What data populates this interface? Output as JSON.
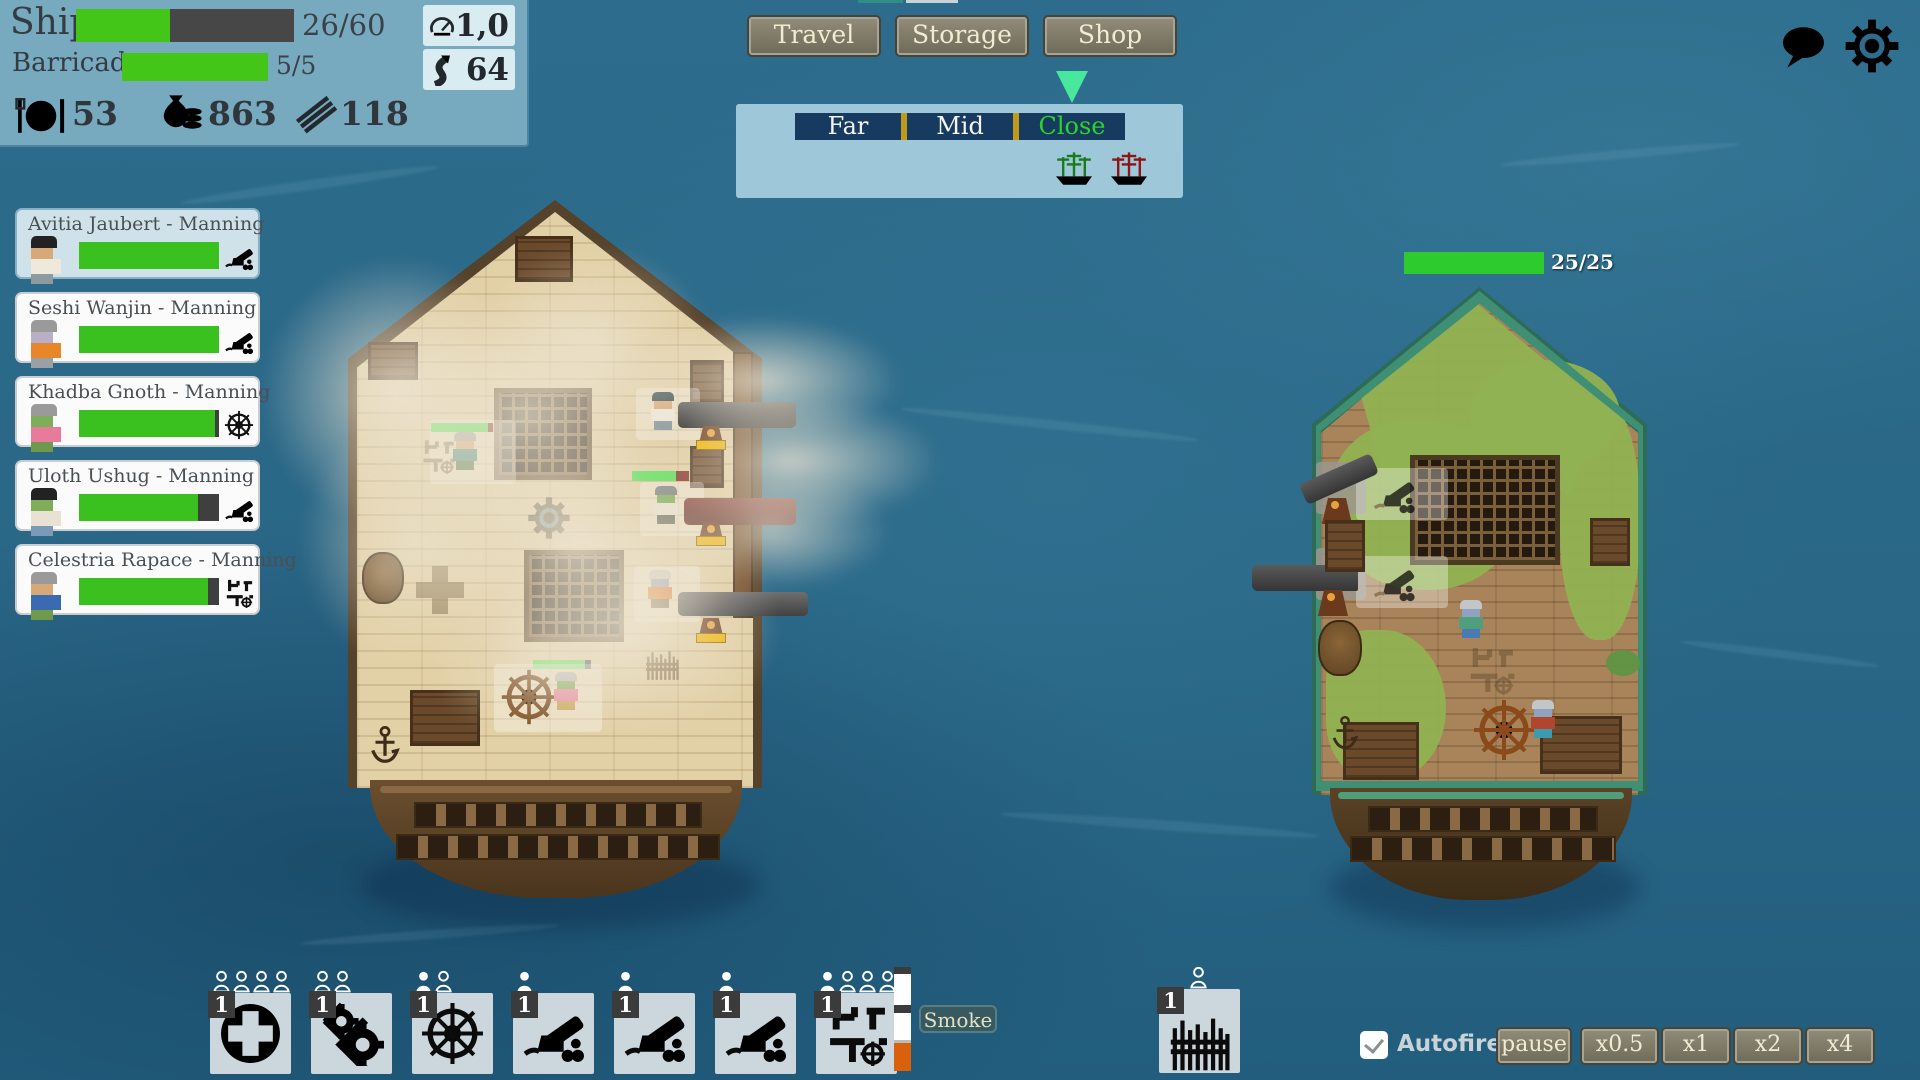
{
  "hud": {
    "ship_label": "Ship",
    "ship_value": "26/60",
    "ship_pct": 43,
    "barricade_label": "Barricade",
    "barricade_value": "5/5",
    "barricade_pct": 100,
    "food": "53",
    "gold": "863",
    "planks": "118",
    "speed": "1,0",
    "distance": "64"
  },
  "top_nav": {
    "travel": "Travel",
    "storage": "Storage",
    "shop": "Shop"
  },
  "range": {
    "far": "Far",
    "mid": "Mid",
    "close": "Close",
    "selected": "Close"
  },
  "crew": [
    {
      "name": "Avitia Jaubert - Manning",
      "hp_pct": 100,
      "station": "cannon",
      "selected": true
    },
    {
      "name": "Seshi Wanjin - Manning",
      "hp_pct": 100,
      "station": "cannon",
      "selected": false
    },
    {
      "name": "Khadba Gnoth - Manning",
      "hp_pct": 97,
      "station": "helm",
      "selected": false
    },
    {
      "name": "Uloth Ushug - Manning",
      "hp_pct": 85,
      "station": "cannon",
      "selected": false
    },
    {
      "name": "Celestria Rapace - Manning",
      "hp_pct": 92,
      "station": "deck-plan",
      "selected": false
    }
  ],
  "enemy": {
    "hp_text": "25/25",
    "hp_pct": 100
  },
  "deck_bars": {
    "station_hp": 92,
    "gun2_hp": 78,
    "helm_hp": 90,
    "reload1": 100,
    "reload2": 100,
    "reload3": 100
  },
  "actions": [
    {
      "name": "heal",
      "badge": "1",
      "slots_filled": 0,
      "slots_empty": 4
    },
    {
      "name": "repair",
      "badge": "1",
      "slots_filled": 0,
      "slots_empty": 2
    },
    {
      "name": "helm",
      "badge": "1",
      "slots_filled": 1,
      "slots_empty": 1
    },
    {
      "name": "cannon-1",
      "badge": "1",
      "slots_filled": 1,
      "slots_empty": 0
    },
    {
      "name": "cannon-2",
      "badge": "1",
      "slots_filled": 1,
      "slots_empty": 0
    },
    {
      "name": "cannon-3",
      "badge": "1",
      "slots_filled": 1,
      "slots_empty": 0
    },
    {
      "name": "deck-stations",
      "badge": "1",
      "slots_filled": 1,
      "slots_empty": 3
    },
    {
      "name": "barricade",
      "badge": "1",
      "slots_filled": 0,
      "slots_empty": 1
    }
  ],
  "gauge": {
    "segments": [
      {
        "color": "#3b3b3b",
        "pct": 7
      },
      {
        "color": "#ffffff",
        "pct": 30
      },
      {
        "color": "#3b3b3b",
        "pct": 7
      },
      {
        "color": "#ffffff",
        "pct": 26
      },
      {
        "color": "#bcbcbc",
        "pct": 3
      },
      {
        "color": "#d9610e",
        "pct": 27
      }
    ]
  },
  "smoke_label": "Smoke",
  "controls": {
    "autofire": "Autofire",
    "autofire_checked": true,
    "pause": "pause",
    "speeds": [
      "x0.5",
      "x1",
      "x2",
      "x4"
    ]
  },
  "colors": {
    "hp_green": "#44c618",
    "enemy_hp_green": "#2ecb2e",
    "reload_yellow": "#f0b400",
    "close_green": "#2bd42b",
    "arrow_green": "#47e79e",
    "gauge_orange": "#d9610e",
    "water": "#2a6889"
  }
}
